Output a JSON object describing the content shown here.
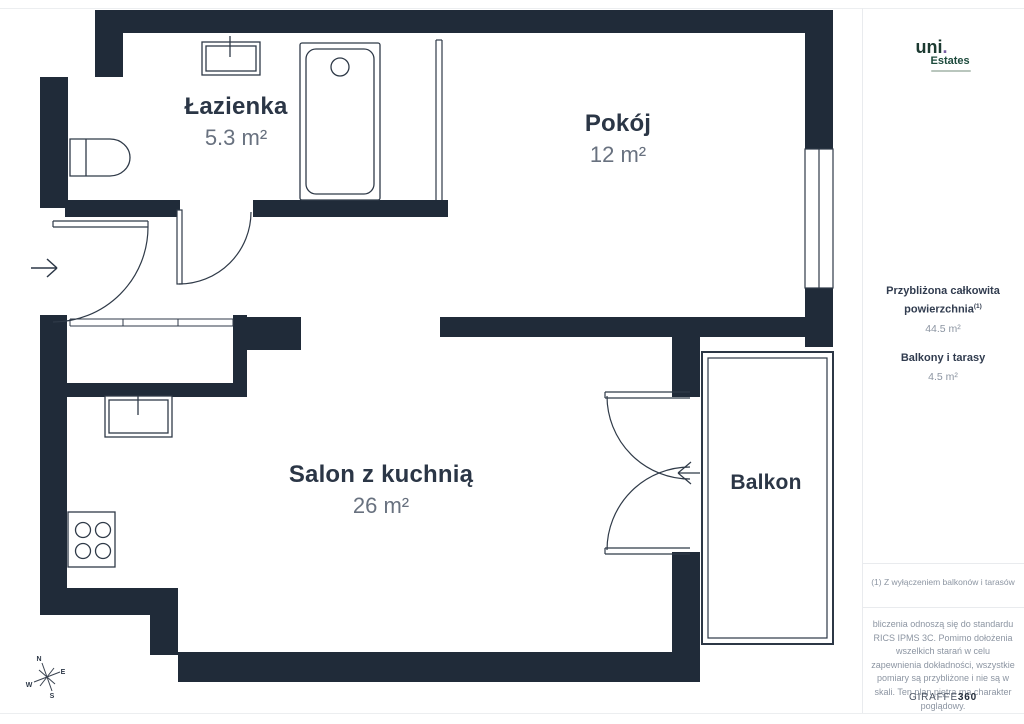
{
  "branding": {
    "logo_main": "uni",
    "logo_dot": ".",
    "logo_sub": "Estates"
  },
  "rooms": [
    {
      "name": "Łazienka",
      "area": "5.3 m²"
    },
    {
      "name": "Pokój",
      "area": "12 m²"
    },
    {
      "name": "Salon z kuchnią",
      "area": "26 m²"
    },
    {
      "name": "Balkon",
      "area": ""
    }
  ],
  "sidebar": {
    "total_label_line1": "Przybliżona całkowita",
    "total_label_line2": "powierzchnia",
    "total_sup": "(1)",
    "total_value": "44.5 m²",
    "balcony_label": "Balkony i tarasy",
    "balcony_value": "4.5 m²",
    "footnote": "(1) Z wyłączeniem balkonów i tarasów",
    "disclaimer": "bliczenia odnoszą się do standardu RICS IPMS 3C. Pomimo dołożenia wszelkich starań w celu zapewnienia dokładności, wszystkie pomiary są przybliżone i nie są w skali. Ten plan piętra ma charakter poglądowy.",
    "brand_giraffe": "GIRAFFE",
    "brand_360": "360"
  },
  "compass": {
    "n": "N",
    "e": "E",
    "w": "W",
    "s": "S"
  }
}
